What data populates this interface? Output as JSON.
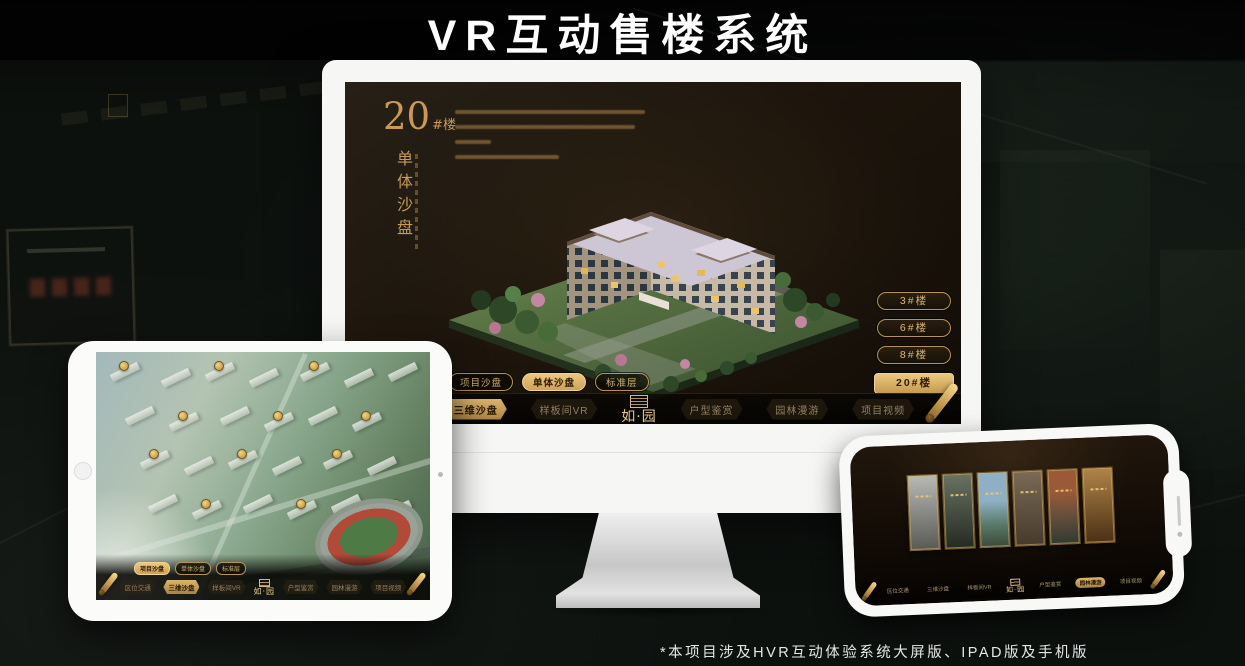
{
  "title": "VR互动售楼系统",
  "footnote": "*本项目涉及HVR互动体验系统大屏版、IPAD版及手机版",
  "brand": {
    "logo": "如·园",
    "gold": "#c9a469"
  },
  "shared_nav": {
    "sub_tabs": [
      "项目沙盘",
      "单体沙盘",
      "标准层"
    ],
    "items": [
      "区位交通",
      "三维沙盘",
      "样板间VR",
      "户型鉴赏",
      "园林漫游",
      "项目视频"
    ]
  },
  "monitor_screen": {
    "block_no": "20",
    "block_suffix": "#楼",
    "section_title": "单体沙盘",
    "building_buttons": [
      "3#楼",
      "6#楼",
      "8#楼",
      "20#楼"
    ],
    "active_building": "20#楼",
    "active_sub_tab": "单体沙盘",
    "active_nav_item": "三维沙盘"
  },
  "ipad_screen": {
    "active_sub_tab": "项目沙盘",
    "active_nav_item": "三维沙盘"
  },
  "phone_screen": {
    "active_nav_item": "园林漫游",
    "gallery_card_count": 6
  }
}
